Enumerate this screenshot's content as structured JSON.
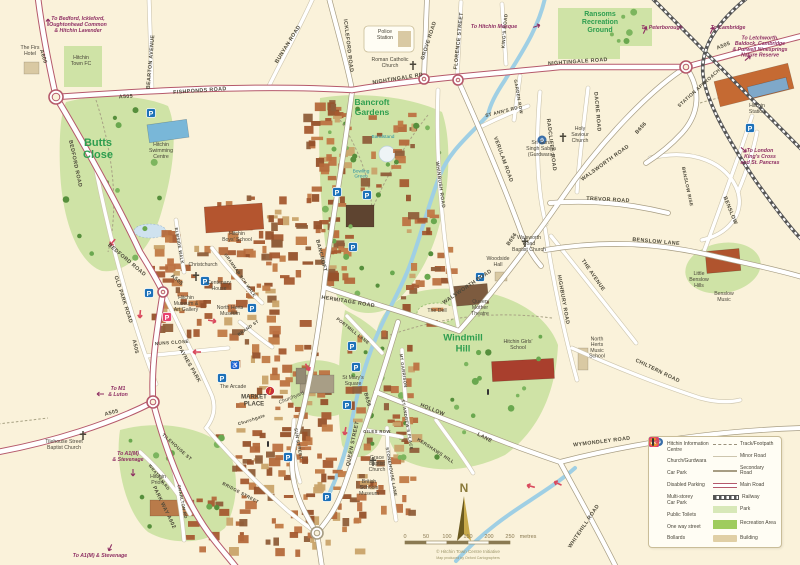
{
  "map": {
    "compass": "N",
    "credit": "© Hitchin Town Centre Initiative",
    "credit_sub": "Map produced by Oxford Cartographers",
    "scale": {
      "ticks": [
        "0",
        "50",
        "100",
        "150",
        "200",
        "250"
      ],
      "unit": "metres"
    },
    "colors": {
      "bg": "#faf2da",
      "park": "#cfe3a6",
      "rec": "#c2dc94",
      "water": "#9fcfe4",
      "main_casing": "#b5596b",
      "sec_casing": "#a79d83",
      "minor_casing": "#cdc5ad",
      "road_text": "#4c4839",
      "place_text": "#4a463a",
      "park_text": "#2e9e4f",
      "dest_text": "#8e2f63",
      "teal_text": "#2a8fa3",
      "carpark_blue": "#1d71b8",
      "multistorey_pink": "#e8426f",
      "info_red": "#c93038",
      "toilets_orange": "#e8912d",
      "oneway_red": "#d94a5e",
      "building_tan": "#d9c9a3",
      "credit_text": "#9b9468"
    },
    "labels": {
      "destinations": [
        [
          "To Bedford, Ickleford,\nOughtonhead Common\n& Hitchin Lavender",
          78,
          26
        ],
        [
          "To Peterborough",
          662,
          29
        ],
        [
          "To Cambridge",
          728,
          29
        ],
        [
          "To Letchworth,\nBaldock, Cambridge\n& Purwell Ninesprings\nNature Reserve",
          760,
          48
        ],
        [
          "To London\nKing's Cross\nand St. Pancras",
          760,
          158
        ],
        [
          "To Hitchin Mosque",
          494,
          28
        ],
        [
          "To M1\n& Luton",
          118,
          393
        ],
        [
          "To A1(M)\n& Stevenage",
          128,
          458
        ],
        [
          "To A1(M) & Stevenage",
          100,
          557
        ]
      ],
      "roads": [
        [
          "A600",
          42,
          57,
          73
        ],
        [
          "A505",
          126,
          98,
          -3
        ],
        [
          "FISHPONDS   ROAD",
          200,
          92,
          -4
        ],
        [
          "BEARTON AVENUE",
          152,
          62,
          -85
        ],
        [
          "BUNYAN ROAD",
          289,
          45,
          -58
        ],
        [
          "ICKLEFORD   ROAD",
          347,
          46,
          83
        ],
        [
          "NIGHTINGALE   RD",
          398,
          80,
          -9
        ],
        [
          "NIGHTINGALE   ROAD",
          578,
          63,
          -4
        ],
        [
          "A505",
          724,
          47,
          -22
        ],
        [
          "GROVE ROAD",
          430,
          41,
          -72
        ],
        [
          "FLORENCE STREET",
          460,
          41,
          -84
        ],
        [
          "KING'S ROAD",
          506,
          31,
          -85,
          4.6
        ],
        [
          "GARDEN ROW",
          517,
          97,
          80,
          4.4
        ],
        [
          "ST ANN'S RD",
          502,
          113,
          -14,
          4.6
        ],
        [
          "VERULAM   ROAD",
          502,
          160,
          70
        ],
        [
          "RADCLIFFE   ROAD",
          550,
          145,
          83
        ],
        [
          "DACRE   ROAD",
          596,
          112,
          85
        ],
        [
          "STATION APPROACH",
          700,
          89,
          -42,
          4.8
        ],
        [
          "B656",
          642,
          129,
          -48
        ],
        [
          "WALSWORTH   ROAD",
          606,
          164,
          -36
        ],
        [
          "TREVOR   ROAD",
          608,
          201,
          3
        ],
        [
          "BENSLOW   LANE",
          656,
          243,
          5
        ],
        [
          "BENSLOW",
          729,
          211,
          68
        ],
        [
          "BENSLOW  RISE",
          686,
          187,
          78,
          4.6
        ],
        [
          "HIGHBURY   ROAD",
          562,
          300,
          80
        ],
        [
          "THE   AVENUE",
          592,
          276,
          55
        ],
        [
          "CHILTERN   ROAD",
          657,
          372,
          26
        ],
        [
          "B656",
          513,
          240,
          -55
        ],
        [
          "WALSWORTH  ROAD",
          468,
          288,
          -34
        ],
        [
          "WHINBUSH   ROAD",
          439,
          185,
          82,
          4.8
        ],
        [
          "BANCROFT",
          320,
          256,
          76
        ],
        [
          "HERMITAGE ROAD",
          348,
          303,
          9
        ],
        [
          "PORTMILL LANE",
          352,
          332,
          38,
          4.4
        ],
        [
          "B656",
          366,
          400,
          75
        ],
        [
          "QUEEN   STREET",
          354,
          444,
          -78
        ],
        [
          "HOLLOW",
          432,
          411,
          22
        ],
        [
          "LANE",
          484,
          439,
          28
        ],
        [
          "WYMONDLEY   ROAD",
          602,
          443,
          -7
        ],
        [
          "WHITEHILL   ROAD",
          585,
          527,
          -56
        ],
        [
          "KERSHAWS  HILL",
          435,
          452,
          33,
          4.6
        ],
        [
          "ST ANDREW'S PLACE",
          406,
          425,
          80,
          4.2
        ],
        [
          "MT GARRISON",
          402,
          371,
          82,
          4.2
        ],
        [
          "STONEHOUSE  LANE",
          390,
          472,
          80,
          4.4
        ],
        [
          "GILES ROW",
          377,
          433,
          0,
          4.2
        ],
        [
          "OLD   PARK   ROAD",
          122,
          300,
          72
        ],
        [
          "BEDFORD   ROAD",
          74,
          164,
          78
        ],
        [
          "BEDFORD   ROAD",
          126,
          261,
          40
        ],
        [
          "A505",
          176,
          281,
          40
        ],
        [
          "A505",
          134,
          347,
          78
        ],
        [
          "A505",
          112,
          414,
          -15
        ],
        [
          "NUNS  CLOSE",
          172,
          344,
          -4,
          4.6
        ],
        [
          "PAYNES  PARK",
          188,
          365,
          60
        ],
        [
          "PARK WAY   A602",
          163,
          508,
          64
        ],
        [
          "TILEHOUSE  ST",
          176,
          448,
          42,
          4.6
        ],
        [
          "BRIDGE  STREET",
          240,
          494,
          28,
          4.4
        ],
        [
          "WRATTEN  RD",
          158,
          478,
          52,
          4.2
        ],
        [
          "CHARLTON  RD",
          181,
          502,
          78,
          4.2
        ],
        [
          "ELMSIDE  WALK",
          178,
          246,
          80,
          4.2
        ],
        [
          "GRAMMAR SCH WALK",
          239,
          276,
          55,
          4.2
        ],
        [
          "BRAND ST",
          249,
          329,
          -35,
          4.2
        ],
        [
          "SUN  STREET",
          297,
          444,
          80,
          4.4
        ],
        [
          "Churchgate",
          252,
          421,
          -18,
          4.4
        ]
      ],
      "places": [
        [
          "The Firs\nHotel",
          30,
          52
        ],
        [
          "Hitchin\nTown FC",
          81,
          62
        ],
        [
          "Hitchin\nSwimming\nCentre",
          161,
          152
        ],
        [
          "Police\nStation",
          385,
          36
        ],
        [
          "Roman Catholic\nChurch",
          390,
          64
        ],
        [
          "Hitchin\nStation",
          757,
          110
        ],
        [
          "Holy\nSaviour\nChurch",
          580,
          136
        ],
        [
          "Sri Guru\nSingh Sabha\n(Gurdwara)",
          541,
          150
        ],
        [
          "Walsworth\nRoad\nBaptist Church",
          529,
          245
        ],
        [
          "Woodside\nHall",
          498,
          263
        ],
        [
          "Queen\nMother\nTheatre",
          480,
          309
        ],
        [
          "The Dell",
          437,
          312
        ],
        [
          "Hitchin Girls'\nSchool",
          518,
          346
        ],
        [
          "North\nHerts\nMusic\nSchool",
          597,
          349
        ],
        [
          "Little\nBenslow\nHills",
          699,
          281
        ],
        [
          "Benslow\nMusic",
          724,
          298
        ],
        [
          "Hitchin\nBoys' School",
          237,
          238
        ],
        [
          "Christchurch",
          203,
          266
        ],
        [
          "Centenary\nHouse",
          219,
          287
        ],
        [
          "Hitchin\nMuseum &\nArt Gallery",
          186,
          305
        ],
        [
          "North Herts\nMuseum",
          230,
          312
        ],
        [
          "The Arcade",
          233,
          388
        ],
        [
          "MARKET\nPLACE",
          254,
          402,
          1
        ],
        [
          "Churchyard",
          292,
          399,
          0,
          -22
        ],
        [
          "St Mary's\nSquare",
          353,
          382
        ],
        [
          "Grace\nBaptist\nChurch",
          377,
          465
        ],
        [
          "British\nSchools\nMuseum",
          369,
          489
        ],
        [
          "Tilehouse Street\nBaptist Church",
          64,
          446
        ],
        [
          "Hitchin\nPriory",
          158,
          481
        ]
      ],
      "parks": [
        [
          "Butts\nClose",
          98,
          152,
          11
        ],
        [
          "Bancroft\nGardens",
          372,
          110,
          8.5
        ],
        [
          "Windmill\nHill",
          463,
          346,
          9.5
        ],
        [
          "Ransoms\nRecreation\nGround",
          600,
          24,
          7
        ]
      ],
      "teal": [
        [
          "Bandstand",
          383,
          138
        ],
        [
          "Bowling\nGreen",
          361,
          175
        ]
      ]
    },
    "icons": {
      "car_parks": [
        [
          151,
          113
        ],
        [
          337,
          192
        ],
        [
          367,
          195
        ],
        [
          353,
          247
        ],
        [
          205,
          281
        ],
        [
          149,
          293
        ],
        [
          252,
          308
        ],
        [
          222,
          378
        ],
        [
          352,
          346
        ],
        [
          356,
          367
        ],
        [
          347,
          405
        ],
        [
          288,
          457
        ],
        [
          327,
          497
        ],
        [
          480,
          277
        ],
        [
          750,
          128
        ]
      ],
      "multi_storey": [
        [
          167,
          317
        ]
      ],
      "disabled": [
        [
          235,
          365
        ]
      ],
      "info": [
        [
          270,
          391
        ]
      ],
      "bollards": [
        [
          488,
          392
        ],
        [
          268,
          444
        ]
      ],
      "one_way": [
        [
          112,
          243,
          130
        ],
        [
          140,
          315,
          95
        ],
        [
          213,
          321,
          10
        ],
        [
          196,
          352,
          180
        ],
        [
          345,
          432,
          100
        ],
        [
          308,
          368,
          60
        ],
        [
          530,
          486,
          195
        ],
        [
          557,
          483,
          205
        ]
      ],
      "churches": [
        [
          413,
          66
        ],
        [
          196,
          277
        ],
        [
          563,
          138
        ],
        [
          525,
          243
        ],
        [
          83,
          436
        ],
        [
          373,
          462
        ]
      ],
      "gurdwaras": [
        [
          542,
          140
        ]
      ]
    },
    "legend": {
      "left": [
        {
          "icon": "info",
          "label": "Hitchin Information\nCentre"
        },
        {
          "icon": "church-gurdwara",
          "label": "Church/Gurdwara"
        },
        {
          "icon": "car-park",
          "label": "Car Park"
        },
        {
          "icon": "disabled-parking",
          "label": "Disabled Parking"
        },
        {
          "icon": "multi-storey",
          "label": "Multi-storey\nCar Park"
        },
        {
          "icon": "toilets",
          "label": "Public Toilets"
        },
        {
          "icon": "one-way",
          "label": "One way street"
        },
        {
          "icon": "bollards",
          "label": "Bollards"
        }
      ],
      "right": [
        {
          "swatch": "track",
          "label": "Track/Footpath"
        },
        {
          "swatch": "minor",
          "label": "Minor Road"
        },
        {
          "swatch": "secondary",
          "label": "Secondary Road"
        },
        {
          "swatch": "main",
          "label": "Main Road"
        },
        {
          "swatch": "railway",
          "label": "Railway"
        },
        {
          "swatch": "park",
          "label": "Park"
        },
        {
          "swatch": "recreation",
          "label": "Recreation Area"
        },
        {
          "swatch": "building",
          "label": "Building"
        }
      ]
    }
  }
}
